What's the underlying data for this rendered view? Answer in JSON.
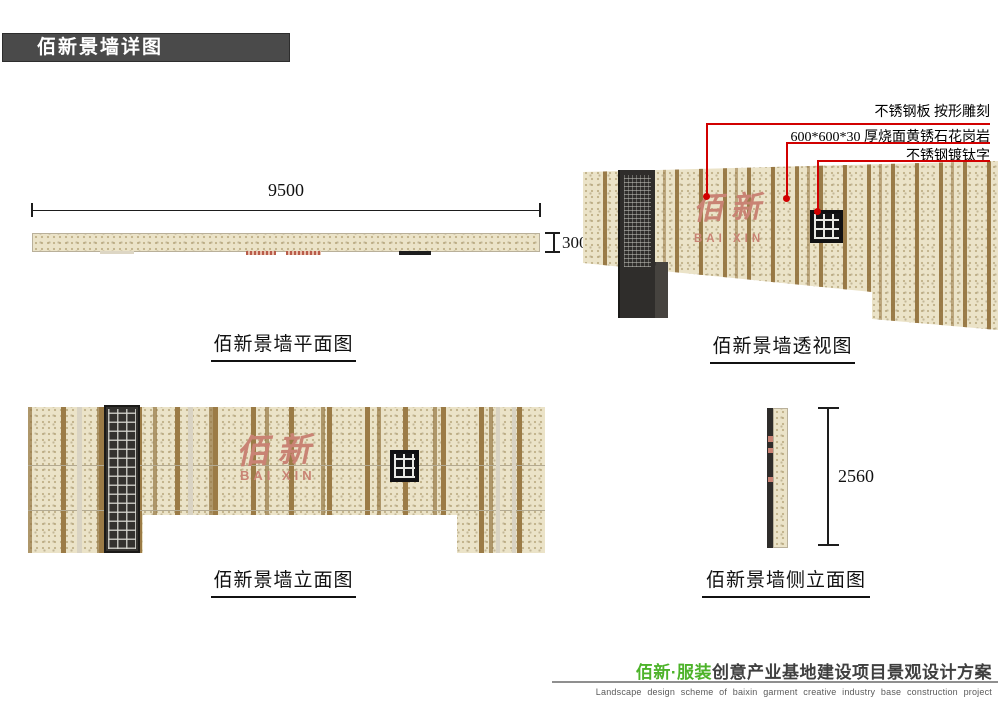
{
  "title_bar": {
    "label": "佰新景墙详图"
  },
  "plan": {
    "caption": "佰新景墙平面图",
    "width_dim": "9500",
    "thickness_dim": "300"
  },
  "perspective": {
    "caption": "佰新景墙透视图",
    "annotations": [
      {
        "label": "不锈钢板 按形雕刻"
      },
      {
        "label": "600*600*30 厚烧面黄锈石花岗岩"
      },
      {
        "label": "不锈钢镀钛字"
      }
    ],
    "wall_logo": {
      "cn": "佰 新",
      "en": "BAI XIN"
    }
  },
  "elevation": {
    "caption": "佰新景墙立面图",
    "wall_logo": {
      "cn": "佰 新",
      "en": "BAI XIN"
    }
  },
  "side_elevation": {
    "caption": "佰新景墙侧立面图",
    "height_dim": "2560"
  },
  "footer": {
    "brand": "佰新·服装",
    "project": "创意产业基地建设项目景观设计方案",
    "subtitle_en": "Landscape design scheme of baixin garment creative industry base construction project"
  },
  "colors": {
    "granite": "#ebe3c8",
    "stripe_brown": "#9b7b46",
    "leader_red": "#d10000",
    "logo_pink": "#c98374",
    "brand_green": "#4db32a",
    "titlebar_gray": "#4a4a4a"
  }
}
